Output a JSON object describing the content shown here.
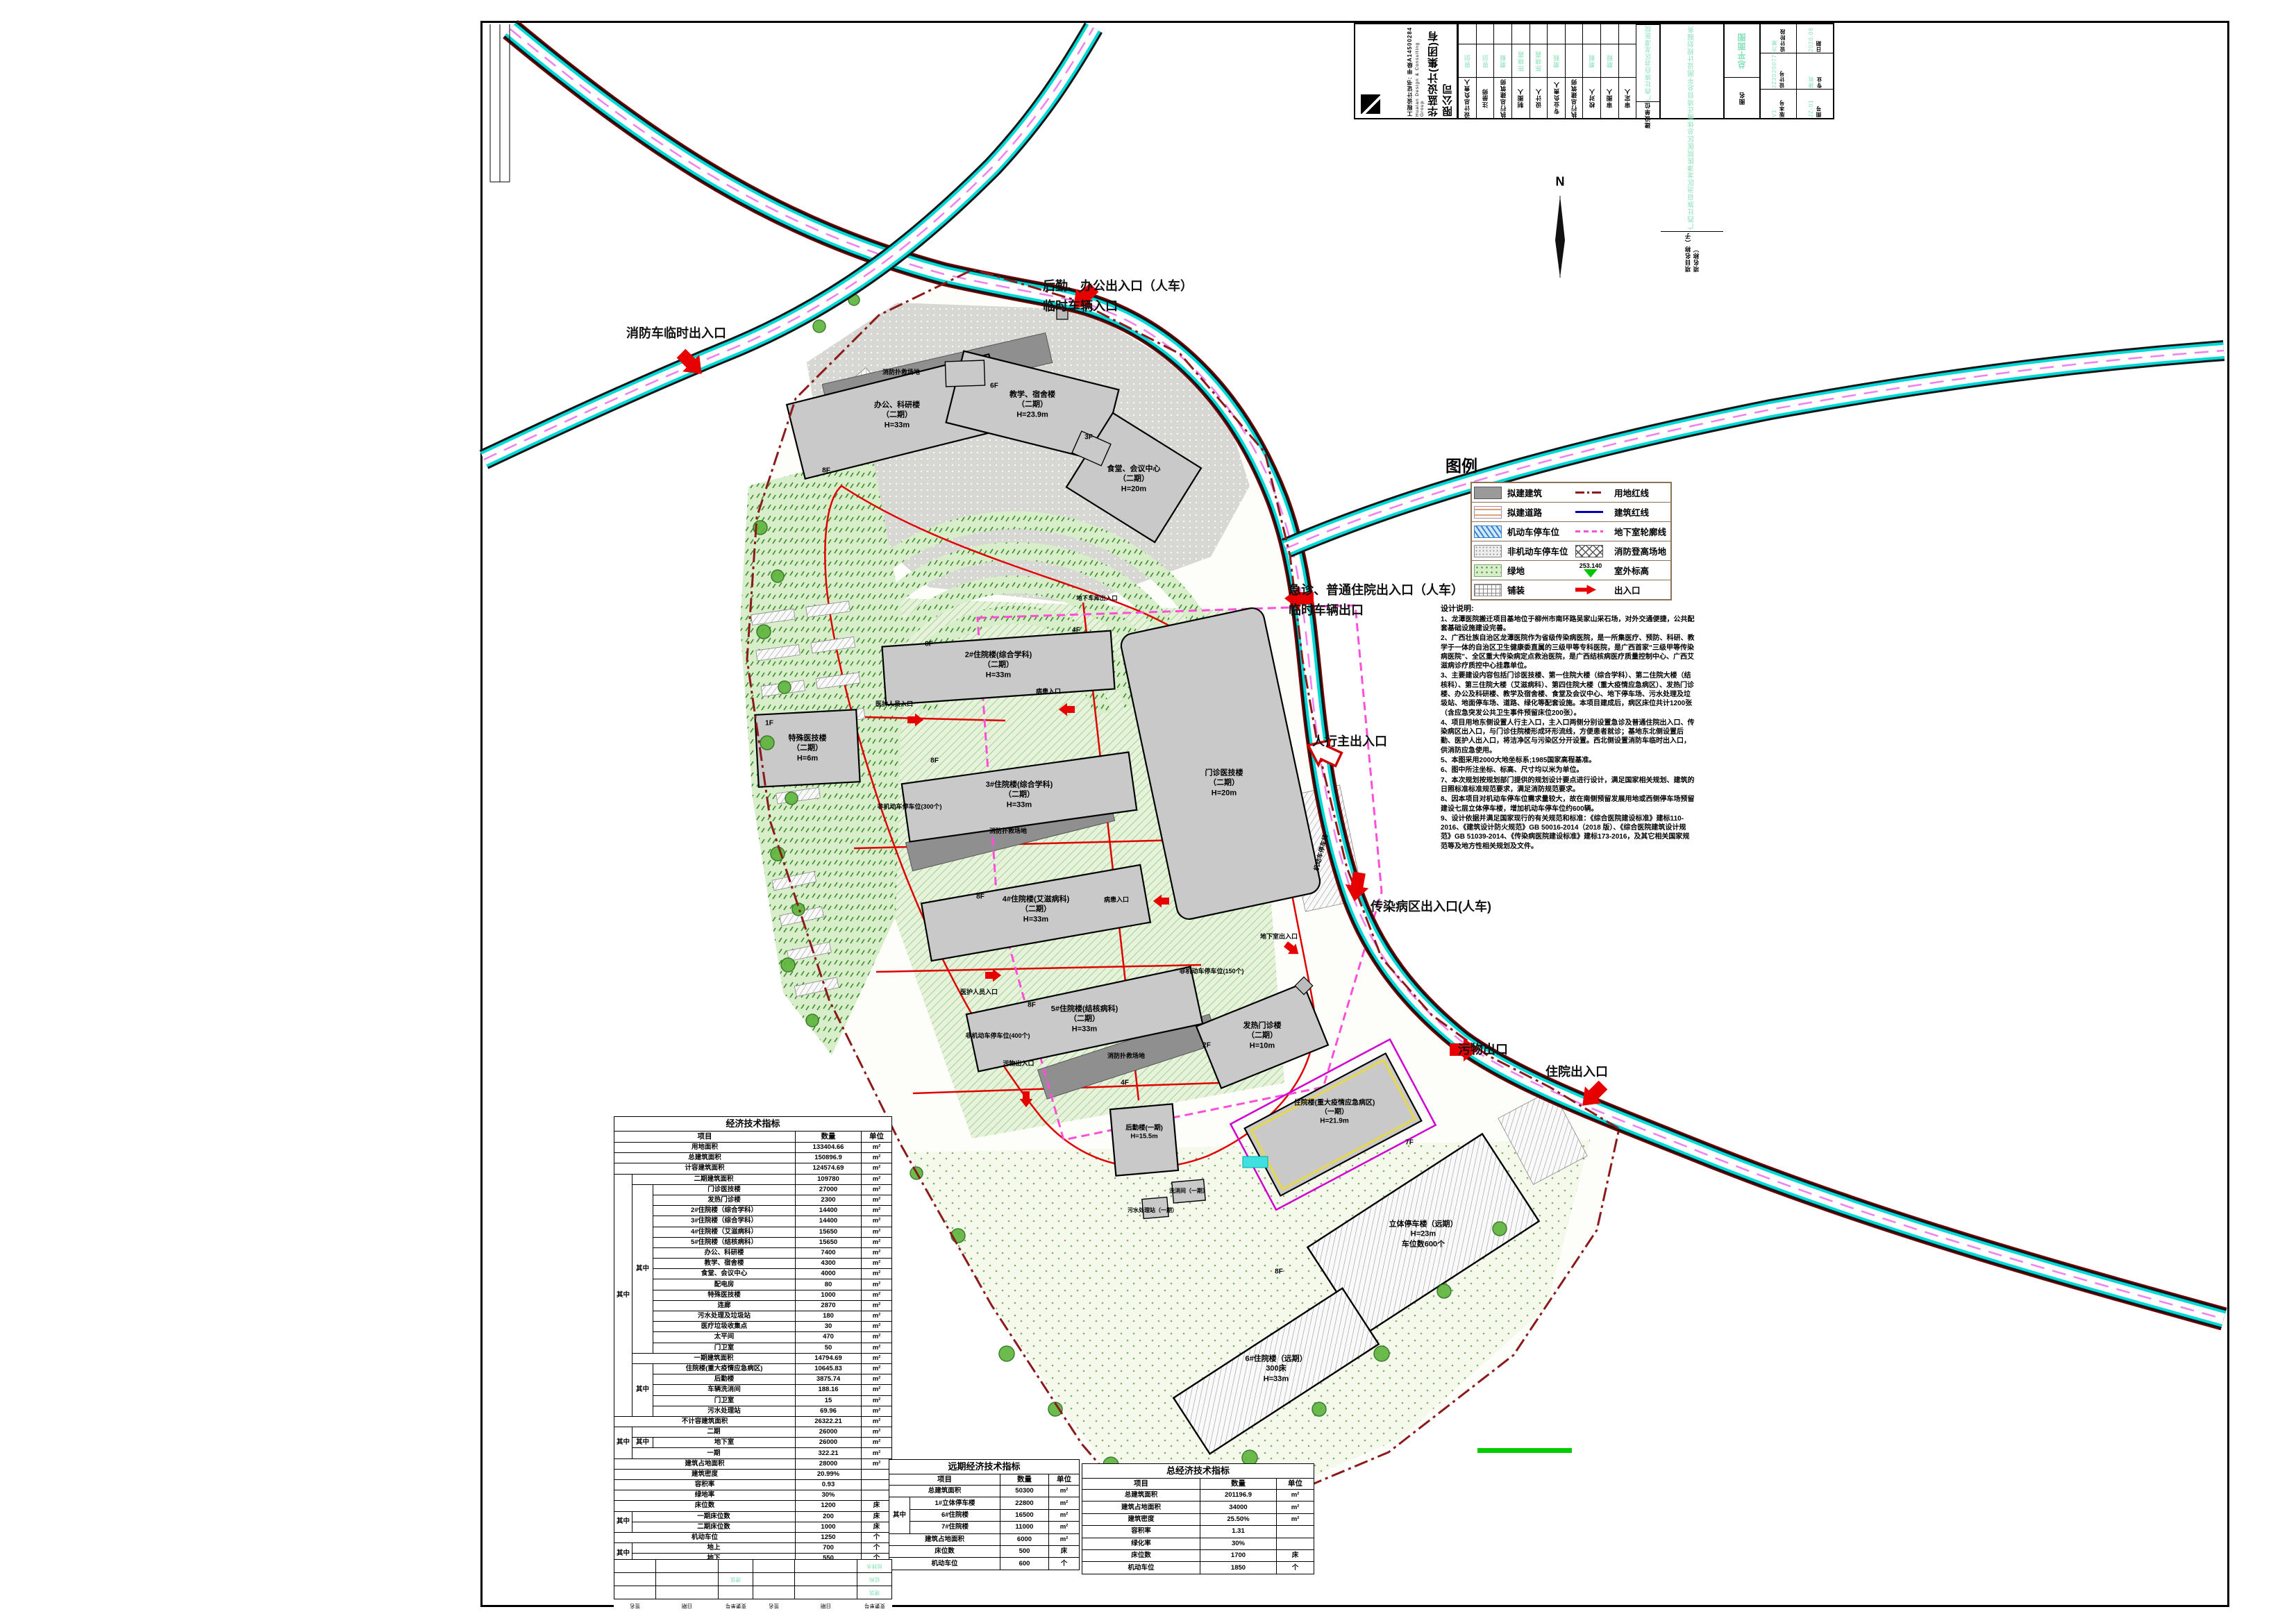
{
  "title_block": {
    "company_cn": "华蓝设计(集团)有限公司",
    "company_en": "Hualan Design & Consulting Group",
    "cert": "工程设计证书: 甲级A14500284",
    "rows": [
      {
        "label": "设计总负责人",
        "value": "曾剑"
      },
      {
        "label": "注册师",
        "value": "曾剑"
      },
      {
        "label": "执行总建筑师",
        "value": "磨毅"
      },
      {
        "label": "制图人",
        "value": "陈晓霞"
      },
      {
        "label": "设计人",
        "value": "陈晓霞"
      },
      {
        "label": "专业负责人",
        "value": "磨毅"
      },
      {
        "label": "执行总建筑师",
        "value": ""
      },
      {
        "label": "校对人",
        "value": "磨毅"
      },
      {
        "label": "审图人",
        "value": "磨毅"
      },
      {
        "label": "审定人",
        "value": ""
      },
      {
        "label": "建设单位",
        "value": "广西壮族自治区龙潭医院"
      }
    ],
    "project_label": "项目名称（子项名称）",
    "project_value": "广西壮族自治区龙潭医院医区总体搬迁项目总平图设计规划服务",
    "fig_label": "图名",
    "fig_value": "总平面图",
    "stage_label": "设计阶段",
    "stage": "方案",
    "date_label": "日期",
    "date": "2020.06",
    "design_no_label": "设计号",
    "design_no": "JZ2020077",
    "major_label": "专业",
    "major": "建筑",
    "version_label": "版本号",
    "version": "V1",
    "fig_no_label": "图号",
    "fig_no": "JZ-01"
  },
  "legend": {
    "title": "图例",
    "left": [
      {
        "symbol": "building-swatch",
        "label": "拟建建筑"
      },
      {
        "symbol": "road-swatch",
        "label": "拟建道路"
      },
      {
        "symbol": "car-parking-swatch",
        "label": "机动车停车位"
      },
      {
        "symbol": "bike-parking-swatch",
        "label": "非机动车停车位"
      },
      {
        "symbol": "green-swatch",
        "label": "绿地"
      },
      {
        "symbol": "paving-swatch",
        "label": "铺装"
      }
    ],
    "right": [
      {
        "symbol": "red-dashdot-line",
        "label": "用地红线"
      },
      {
        "symbol": "blue-line",
        "label": "建筑红线"
      },
      {
        "symbol": "magenta-dash-line",
        "label": "地下室轮廓线"
      },
      {
        "symbol": "crosshatch-swatch",
        "label": "消防登高场地"
      },
      {
        "symbol": "elevation-marker",
        "label": "室外标高"
      },
      {
        "symbol": "entrance-arrow",
        "label": "出入口"
      }
    ],
    "elevation_value": "253.140"
  },
  "notes": {
    "title": "设计说明:",
    "items": [
      "1、龙潭医院搬迁项目基地位于柳州市南环路吴家山采石场，对外交通便捷，公共配套基础设施建设完善。",
      "2、广西壮族自治区龙潭医院作为省级传染病医院，是一所集医疗、预防、科研、教学于一体的自治区卫生健康委直属的三级甲等专科医院，是广西首家“三级甲等传染病医院”、全区重大传染病定点救治医院，是广西结核病医疗质量控制中心、广西艾滋病诊疗质控中心挂靠单位。",
      "3、主要建设内容包括门诊医技楼、第一住院大楼（综合学科）、第二住院大楼（结核科）、第三住院大楼（艾滋病科）、第四住院大楼（重大疫情应急病区）、发热门诊楼、办公及科研楼、教学及宿舍楼、食堂及会议中心、地下停车场、污水处理及垃圾站、地面停车场、道路、绿化等配套设施。本项目建成后，病区床位共计1200张（含应急突发公共卫生事件预留床位200张）。",
      "4、项目用地东侧设置人行主入口，主入口两侧分别设置急诊及普通住院出入口、传染病区出入口，与门诊住院楼形成环形流线，方便患者就诊；基地东北侧设置后勤、医护人出入口，将洁净区与污染区分开设置。西北侧设置消防车临时出入口，供消防应急使用。",
      "5、本图采用2000大地坐标系;1985国家高程基准。",
      "6、图中所注坐标、标高、尺寸均以米为单位。",
      "7、本次规划按规划部门提供的规划设计要点进行设计，满足国家相关规划、建筑的日照标准标准规范要求，满足消防规范要求。",
      "8、因本项目对机动车停车位需求量较大，故在南侧预留发展用地或西侧停车场预留建设七层立体停车楼，增加机动车停车位约600辆。",
      "9、设计依据并满足国家现行的有关规范和标准：《综合医院建设标准》建标110-2016、《建筑设计防火规范》GB 50016-2014（2018 版）、《综合医院建筑设计规范》GB 51039-2014、《传染病医院建设标准》建标173-2016，及其它相关国家规范等及地方性相关规划及文件。"
    ]
  },
  "plan": {
    "compass": "N",
    "entrances": [
      "消防车临时出入口",
      "后勤、办公出入口（人车）\n临时车辆入口",
      "急诊、普通住院出入口（人车）\n临时车辆出口",
      "人行主出入口",
      "传染病区出入口(人车)",
      "污物出口",
      "住院出入口"
    ],
    "buildings": [
      "办公、科研楼\n（二期）\nH=33m",
      "教学、宿舍楼\n（二期）\nH=23.9m",
      "食堂、会议中心\n（二期）\nH=20m",
      "2#住院楼(综合学科)\n（二期）\nH=33m",
      "3#住院楼(综合学科)\n（二期）\nH=33m",
      "特殊医技楼\n（二期）\nH=6m",
      "门诊医技楼\n（二期）\nH=20m",
      "4#住院楼(艾滋病科)\n（二期）\nH=33m",
      "5#住院楼(结核病科)\n（二期）\nH=33m",
      "发热门诊楼\n（二期）\nH=10m",
      "住院楼(重大疫情应急病区)\n（一期）\nH=21.9m",
      "后勤楼(一期)\nH=15.5m",
      "立体停车楼（远期）\nH=23m\n车位数600个",
      "6#住院楼（远期）\n300床\nH=33m"
    ],
    "small_labels": [
      "医护人员入口",
      "病患入口",
      "医护人员入口",
      "病患入口",
      "污物出入口",
      "地下室出入口",
      "非机动车停车位(300个)",
      "非机动车停车位(400个)",
      "非机动车停车位(150个)",
      "消防扑救场地",
      "消防扑救场地",
      "消防扑救场地",
      "机动车停车场",
      "洗消间（一期）",
      "污水处理站（一期）",
      "地下车库出入口"
    ],
    "floor_tags": [
      "8F",
      "6F",
      "3F",
      "8F",
      "8F",
      "1F",
      "4F",
      "8F",
      "8F",
      "2F",
      "7F",
      "8F",
      "4F"
    ]
  },
  "tables": {
    "main": {
      "title": "经济技术指标",
      "headers": [
        "项目",
        "数量",
        "单位"
      ],
      "group_label": "其中",
      "rows": [
        {
          "item": "用地面积",
          "qty": "133404.66",
          "unit": "m²"
        },
        {
          "item": "总建筑面积",
          "qty": "150896.9",
          "unit": "m²"
        },
        {
          "item": "计容建筑面积",
          "qty": "124574.69",
          "unit": "m²"
        },
        {
          "item": "二期建筑面积",
          "qty": "109780",
          "unit": "m²"
        },
        {
          "item": "门诊医技楼",
          "qty": "27000",
          "unit": "m²"
        },
        {
          "item": "发热门诊楼",
          "qty": "2300",
          "unit": "m²"
        },
        {
          "item": "2#住院楼（综合学科）",
          "qty": "14400",
          "unit": "m²"
        },
        {
          "item": "3#住院楼（综合学科）",
          "qty": "14400",
          "unit": "m²"
        },
        {
          "item": "4#住院楼（艾滋病科）",
          "qty": "15650",
          "unit": "m²"
        },
        {
          "item": "5#住院楼（结核病科）",
          "qty": "15650",
          "unit": "m²"
        },
        {
          "item": "办公、科研楼",
          "qty": "7400",
          "unit": "m²"
        },
        {
          "item": "教学、宿舍楼",
          "qty": "4300",
          "unit": "m²"
        },
        {
          "item": "食堂、会议中心",
          "qty": "4000",
          "unit": "m²"
        },
        {
          "item": "配电房",
          "qty": "80",
          "unit": "m²"
        },
        {
          "item": "特殊医技楼",
          "qty": "1000",
          "unit": "m²"
        },
        {
          "item": "连廊",
          "qty": "2870",
          "unit": "m²"
        },
        {
          "item": "污水处理及垃圾站",
          "qty": "180",
          "unit": "m²"
        },
        {
          "item": "医疗垃圾收集点",
          "qty": "30",
          "unit": "m²"
        },
        {
          "item": "太平间",
          "qty": "470",
          "unit": "m²"
        },
        {
          "item": "门卫室",
          "qty": "50",
          "unit": "m²"
        },
        {
          "item": "一期建筑面积",
          "qty": "14794.69",
          "unit": "m²"
        },
        {
          "item": "住院楼(重大疫情应急病区)",
          "qty": "10645.83",
          "unit": "m²"
        },
        {
          "item": "后勤楼",
          "qty": "3875.74",
          "unit": "m²"
        },
        {
          "item": "车辆洗消间",
          "qty": "188.16",
          "unit": "m²"
        },
        {
          "item": "门卫室",
          "qty": "15",
          "unit": "m²"
        },
        {
          "item": "污水处理站",
          "qty": "69.96",
          "unit": "m²"
        },
        {
          "item": "不计容建筑面积",
          "qty": "26322.21",
          "unit": "m²"
        },
        {
          "item": "二期",
          "qty": "26000",
          "unit": "m²"
        },
        {
          "item": "地下室",
          "qty": "26000",
          "unit": "m²"
        },
        {
          "item": "一期",
          "qty": "322.21",
          "unit": "m²"
        },
        {
          "item": "建筑占地面积",
          "qty": "28000",
          "unit": "m²"
        },
        {
          "item": "建筑密度",
          "qty": "20.99%",
          "unit": ""
        },
        {
          "item": "容积率",
          "qty": "0.93",
          "unit": ""
        },
        {
          "item": "绿地率",
          "qty": "30%",
          "unit": ""
        },
        {
          "item": "床位数",
          "qty": "1200",
          "unit": "床"
        },
        {
          "item": "一期床位数",
          "qty": "200",
          "unit": "床"
        },
        {
          "item": "二期床位数",
          "qty": "1000",
          "unit": "床"
        },
        {
          "item": "机动车位",
          "qty": "1250",
          "unit": "个"
        },
        {
          "item": "地上",
          "qty": "700",
          "unit": "个"
        },
        {
          "item": "地下",
          "qty": "550",
          "unit": "个"
        },
        {
          "item": "非机动车位",
          "qty": "3740",
          "unit": "个"
        }
      ]
    },
    "longterm": {
      "title": "远期经济技术指标",
      "headers": [
        "项目",
        "数量",
        "单位"
      ],
      "group_label": "其中",
      "rows": [
        {
          "item": "总建筑面积",
          "qty": "50300",
          "unit": "m²"
        },
        {
          "item": "1#立体停车楼",
          "qty": "22800",
          "unit": "m²"
        },
        {
          "item": "6#住院楼",
          "qty": "16500",
          "unit": "m²"
        },
        {
          "item": "7#住院楼",
          "qty": "11000",
          "unit": "m²"
        },
        {
          "item": "建筑占地面积",
          "qty": "6000",
          "unit": "m²"
        },
        {
          "item": "床位数",
          "qty": "500",
          "unit": "床"
        },
        {
          "item": "机动车位",
          "qty": "600",
          "unit": "个"
        }
      ]
    },
    "total": {
      "title": "总经济技术指标",
      "headers": [
        "项目",
        "数量",
        "单位"
      ],
      "rows": [
        {
          "item": "总建筑面积",
          "qty": "201196.9",
          "unit": "m²"
        },
        {
          "item": "建筑占地面积",
          "qty": "34000",
          "unit": "m²"
        },
        {
          "item": "建筑密度",
          "qty": "25.50%",
          "unit": "m²"
        },
        {
          "item": "容积率",
          "qty": "1.31",
          "unit": ""
        },
        {
          "item": "绿化率",
          "qty": "30%",
          "unit": ""
        },
        {
          "item": "床位数",
          "qty": "1700",
          "unit": "床"
        },
        {
          "item": "机动车位",
          "qty": "1850",
          "unit": "个"
        }
      ]
    }
  },
  "revision": {
    "cols": [
      "变更单号",
      "签名",
      "日期",
      "变更单号",
      "签名",
      "日期"
    ],
    "disciplines": [
      "给排水",
      "结构",
      "建筑"
    ]
  }
}
